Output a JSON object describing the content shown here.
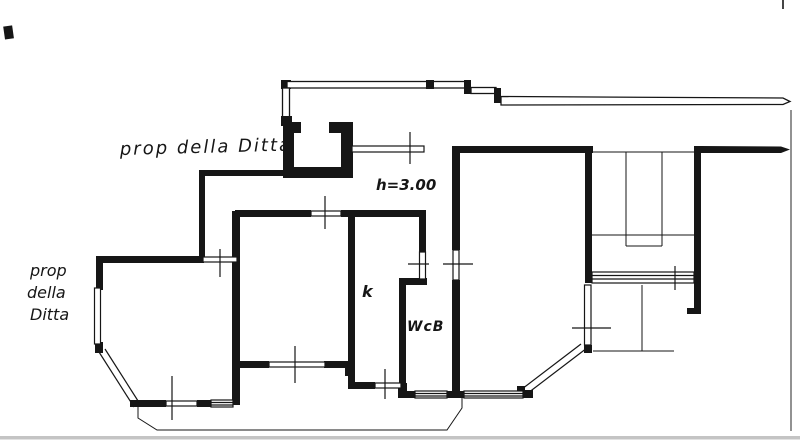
{
  "document": {
    "type": "scanned architectural floor plan (planimetria catastale)",
    "background_color": "#ffffff",
    "ink_color": "#161616",
    "scan_edge_color": "#c4c4c4"
  },
  "labels": {
    "property_note_top": "prop della Ditta",
    "property_note_left": [
      "prop",
      "della",
      "Ditta"
    ],
    "ceiling_height": "h=3.00",
    "kitchen": "k",
    "bathroom": "WcB"
  }
}
